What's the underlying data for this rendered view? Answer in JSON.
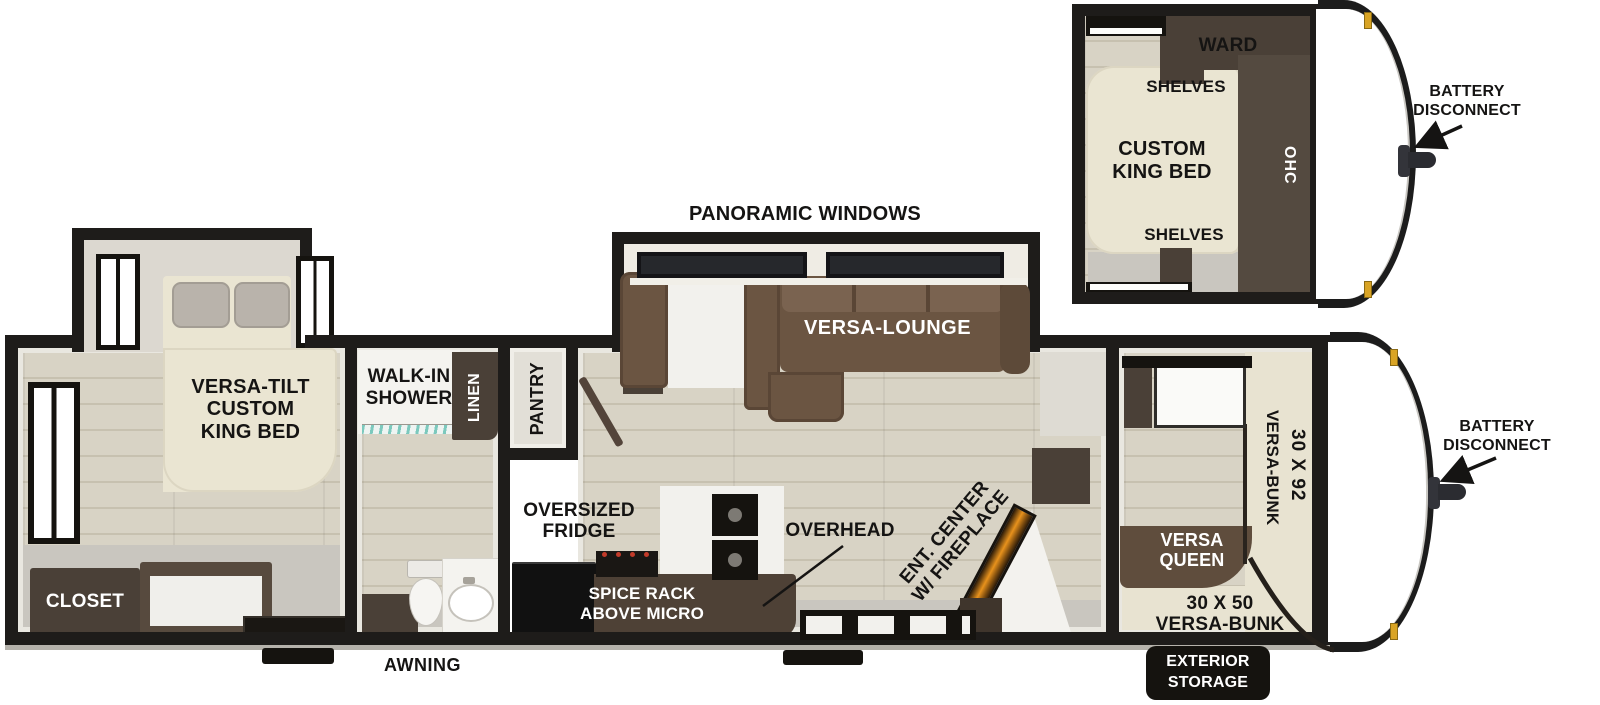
{
  "colors": {
    "wall": "#1e1c1a",
    "floor_wood": "#d8d3c5",
    "cabinet_brown": "#4a4037",
    "sofa_brown": "#6b5542",
    "bed_cream": "#eae5d2",
    "accent_gold": "#d9a425",
    "flame_orange": "#e8921c"
  },
  "inset": {
    "ward": "WARD",
    "shelves_top": "SHELVES",
    "shelves_bottom": "SHELVES",
    "custom_king_line1": "CUSTOM",
    "custom_king_line2": "KING BED",
    "ohc": "OHC",
    "battery_line1": "BATTERY",
    "battery_line2": "DISCONNECT"
  },
  "labels": {
    "panoramic_windows": "PANORAMIC WINDOWS",
    "versa_lounge": "VERSA-LOUNGE",
    "versa_tilt_line1": "VERSA-TILT",
    "versa_tilt_line2": "CUSTOM",
    "versa_tilt_line3": "KING BED",
    "closet": "CLOSET",
    "walk_in_line1": "WALK-IN",
    "walk_in_line2": "SHOWER",
    "linen": "LINEN",
    "pantry": "PANTRY",
    "fridge_line1": "OVERSIZED",
    "fridge_line2": "FRIDGE",
    "spice_line1": "SPICE RACK",
    "spice_line2": "ABOVE MICRO",
    "overhead": "OVERHEAD",
    "ent_line1": "ENT. CENTER",
    "ent_line2": "W/ FIREPLACE",
    "bunk92_size": "30 X 92",
    "bunk92_name": "VERSA-BUNK",
    "queen_line1": "VERSA",
    "queen_line2": "QUEEN",
    "bunk50_size": "30 X 50",
    "bunk50_name": "VERSA-BUNK",
    "battery_line1": "BATTERY",
    "battery_line2": "DISCONNECT",
    "awning": "AWNING",
    "exterior_line1": "EXTERIOR",
    "exterior_line2": "STORAGE"
  }
}
